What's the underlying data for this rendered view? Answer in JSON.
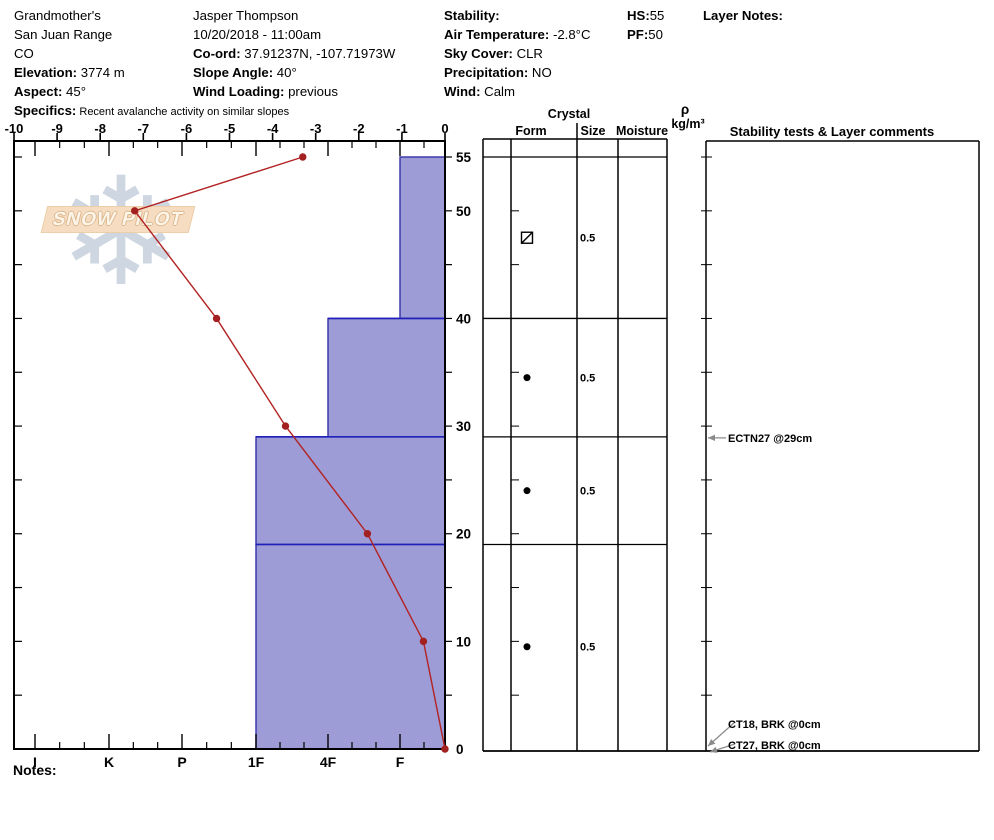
{
  "header": {
    "columns": [
      {
        "x": 14,
        "lines": [
          {
            "t": "Grandmother's"
          },
          {
            "t": "San Juan Range"
          },
          {
            "t": "CO"
          },
          {
            "b": "Elevation:",
            "t": " 3774 m"
          },
          {
            "b": "Aspect:",
            "t": " 45°"
          },
          {
            "b": "Specifics:",
            "t": " Recent avalanche activity on similar slopes",
            "small": true
          }
        ]
      },
      {
        "x": 193,
        "lines": [
          {
            "t": "Jasper Thompson"
          },
          {
            "t": "10/20/2018 - 11:00am"
          },
          {
            "b": "Co-ord:",
            "t": " 37.91237N, -107.71973W"
          },
          {
            "b": "Slope Angle:",
            "t": " 40°"
          },
          {
            "b": "Wind Loading:",
            "t": " previous"
          }
        ]
      },
      {
        "x": 444,
        "lines": [
          {
            "b": "Stability:",
            "t": ""
          },
          {
            "b": "Air Temperature:",
            "t": " -2.8°C"
          },
          {
            "b": "Sky Cover:",
            "t": " CLR"
          },
          {
            "b": "Precipitation:",
            "t": " NO"
          },
          {
            "b": "Wind:",
            "t": "  Calm"
          }
        ]
      },
      {
        "x": 627,
        "lines": [
          {
            "b": "HS:",
            "t": "55"
          },
          {
            "b": "PF:",
            "t": "50"
          }
        ]
      },
      {
        "x": 703,
        "lines": [
          {
            "b": "Layer Notes:",
            "t": ""
          }
        ]
      }
    ]
  },
  "table_headers": {
    "crystal": "Crystal",
    "form": "Form",
    "size": "Size",
    "moisture": "Moisture",
    "rho": "ρ",
    "rho_units": "kg/m³",
    "stability": "Stability tests & Layer comments"
  },
  "notes_label": "Notes:",
  "logo_text": "SNOW PILOT",
  "chart_data": {
    "type": "snow_profile",
    "title": "Snow pit profile: depth (cm) vs temperature (°C) and hand hardness",
    "temperature_axis": {
      "min": -10,
      "max": 0,
      "tick_labels": [
        "-10",
        "-9",
        "-8",
        "-7",
        "-6",
        "-5",
        "-4",
        "-3",
        "-2",
        "-1",
        "0"
      ]
    },
    "depth_axis": {
      "max_cm": 55,
      "labeled_ticks": [
        55,
        50,
        40,
        30,
        20,
        10,
        0
      ],
      "minor_tick_step_cm": 5
    },
    "hardness_axis": {
      "categories": [
        "I",
        "K",
        "P",
        "1F",
        "4F",
        "F"
      ]
    },
    "temperature_profile": [
      {
        "depth_cm": 55,
        "temp_c": -3.3
      },
      {
        "depth_cm": 50,
        "temp_c": -7.2
      },
      {
        "depth_cm": 40,
        "temp_c": -5.3
      },
      {
        "depth_cm": 30,
        "temp_c": -3.7
      },
      {
        "depth_cm": 20,
        "temp_c": -1.8
      },
      {
        "depth_cm": 10,
        "temp_c": -0.5
      },
      {
        "depth_cm": 0,
        "temp_c": 0.0
      }
    ],
    "layers": [
      {
        "top_cm": 55,
        "bottom_cm": 40,
        "hardness": "F",
        "grain_form": "DF",
        "grain_size_mm": "0.5"
      },
      {
        "top_cm": 40,
        "bottom_cm": 29,
        "hardness": "4F",
        "grain_form": "RG",
        "grain_size_mm": "0.5"
      },
      {
        "top_cm": 29,
        "bottom_cm": 19,
        "hardness": "1F",
        "grain_form": "RG",
        "grain_size_mm": "0.5"
      },
      {
        "top_cm": 19,
        "bottom_cm": 0,
        "hardness": "1F",
        "grain_form": "RG",
        "grain_size_mm": "0.5"
      }
    ],
    "stability_tests": [
      {
        "label": "ECTN27 @29cm",
        "depth_cm": 29
      },
      {
        "label": "CT18, BRK @0cm",
        "depth_cm": 0
      },
      {
        "label": "CT27, BRK @0cm",
        "depth_cm": 0
      }
    ],
    "colors": {
      "bar_fill": "#9e9cd6",
      "bar_edge": "#3331a8",
      "layer_line": "#2020bb",
      "temp_line": "#b22222",
      "temp_point": "#a32020",
      "arrow": "#8a8a8a",
      "axis": "#000000"
    },
    "legend_position": "none",
    "grid": false
  }
}
